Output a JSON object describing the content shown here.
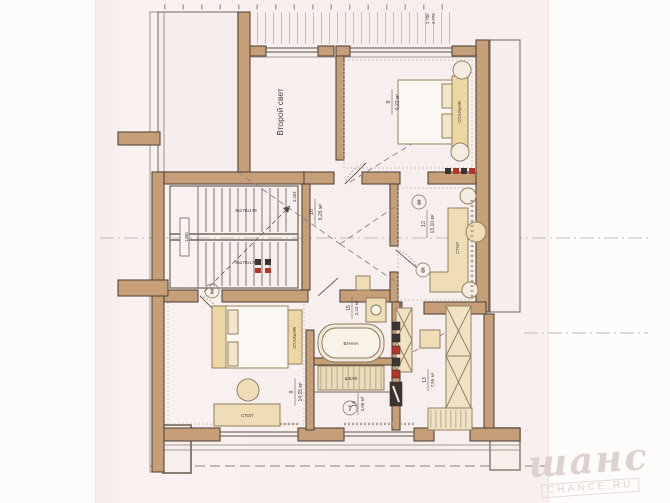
{
  "watermark": {
    "brand": "шанс",
    "site": "CHANCE.RU"
  },
  "plan": {
    "second_light_label": "Второй свет",
    "rooms": [
      {
        "id": "8",
        "area": "9,22 м²"
      },
      {
        "id": "10",
        "area": "6,26 м²"
      },
      {
        "id": "12",
        "area": "13,10 м²"
      },
      {
        "id": "9",
        "area": "14,05 м²"
      },
      {
        "id": "15",
        "area": "3,23 м²"
      },
      {
        "id": "14",
        "area": "3,06 м²"
      },
      {
        "id": "13",
        "area": "7,55 м²"
      }
    ],
    "stairs": {
      "flight_top": "9х270х179",
      "flight_bottom": "9х270х179",
      "width": "1380"
    },
    "dimensions": {
      "a": "2.785",
      "b": "2.772",
      "c": "3.393"
    },
    "furniture": {
      "bed_top": "СПАЛЬНЯ",
      "bed_bottom": "СПАЛЬНЯ",
      "desk_office": "СТОЛ",
      "desk_bedroom": "СТОЛ",
      "bath": "ВАННА",
      "wardrobe": "ШКАФ"
    },
    "callouts": [
      "2",
      "3",
      "5",
      "7"
    ]
  }
}
